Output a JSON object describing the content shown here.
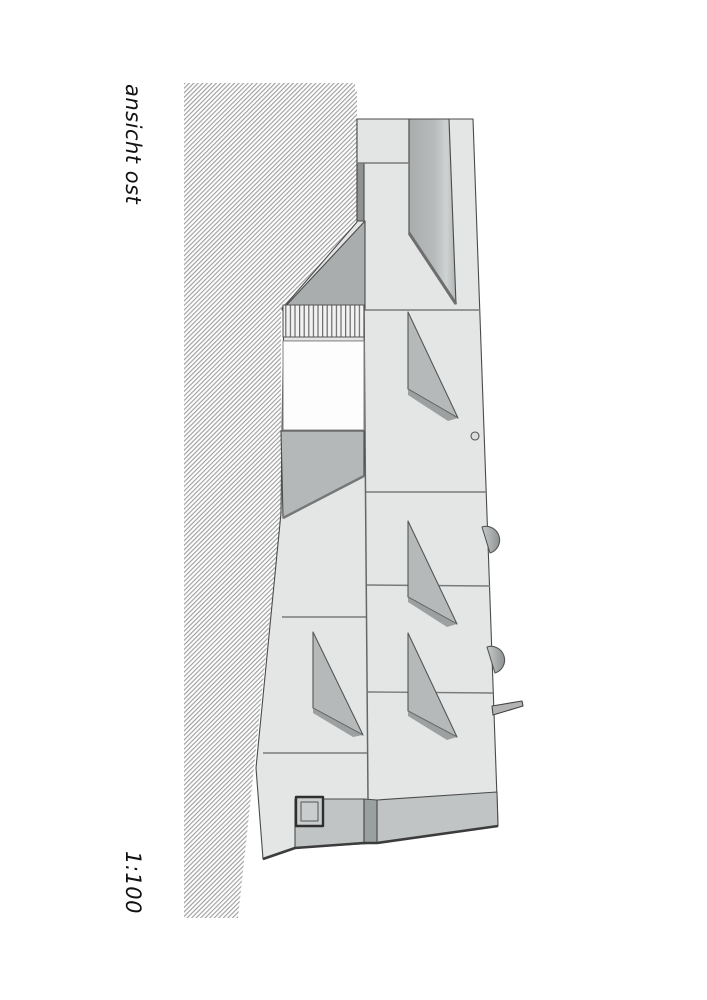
{
  "drawing": {
    "title": "ansicht ost",
    "scale": "1:100",
    "colors": {
      "paper": "#ffffff",
      "facade": "#e4e6e6",
      "panel_dark": "#b5b9b9",
      "gable_shadow": "#a9adad",
      "plinth_band": "#c0c4c4",
      "plinth_strip": "#9aa0a0",
      "terrain_hatch_line": "#a0a0a0",
      "outline": "#4a4a4a",
      "deep_outline": "#333333"
    }
  }
}
